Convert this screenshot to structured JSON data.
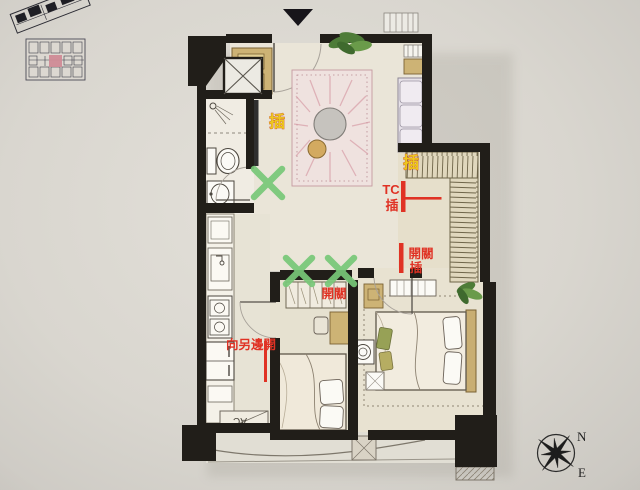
{
  "document": {
    "type": "hand-drawn apartment floor plan photo with renovation markups"
  },
  "annotations": {
    "outlet_tv": "插",
    "outlet_wardrobe": "插",
    "tc_label": "TC",
    "tc_outlet": "插",
    "switch_label": "開關",
    "switch_outlet": "插",
    "shelf_switch": "開關",
    "door_note": "向另邊開",
    "ac_label": "AC"
  },
  "compass": {
    "north": "N",
    "east": "E"
  },
  "colors": {
    "annotation_red": "#e03224",
    "annotation_yellow": "#edc91f",
    "mark_green": "#78c878",
    "wall_black": "#211e19",
    "wood_tan": "#cdb375",
    "keyplan_highlight": "#cf8b96",
    "paper": "#dcd9d2"
  },
  "icons": {
    "entrance_marker_icon": "▼",
    "compass_rose_icon": "✳",
    "green_x_mark_icon": "✕",
    "plant_icon": "❋",
    "washer_icon": "◎"
  }
}
